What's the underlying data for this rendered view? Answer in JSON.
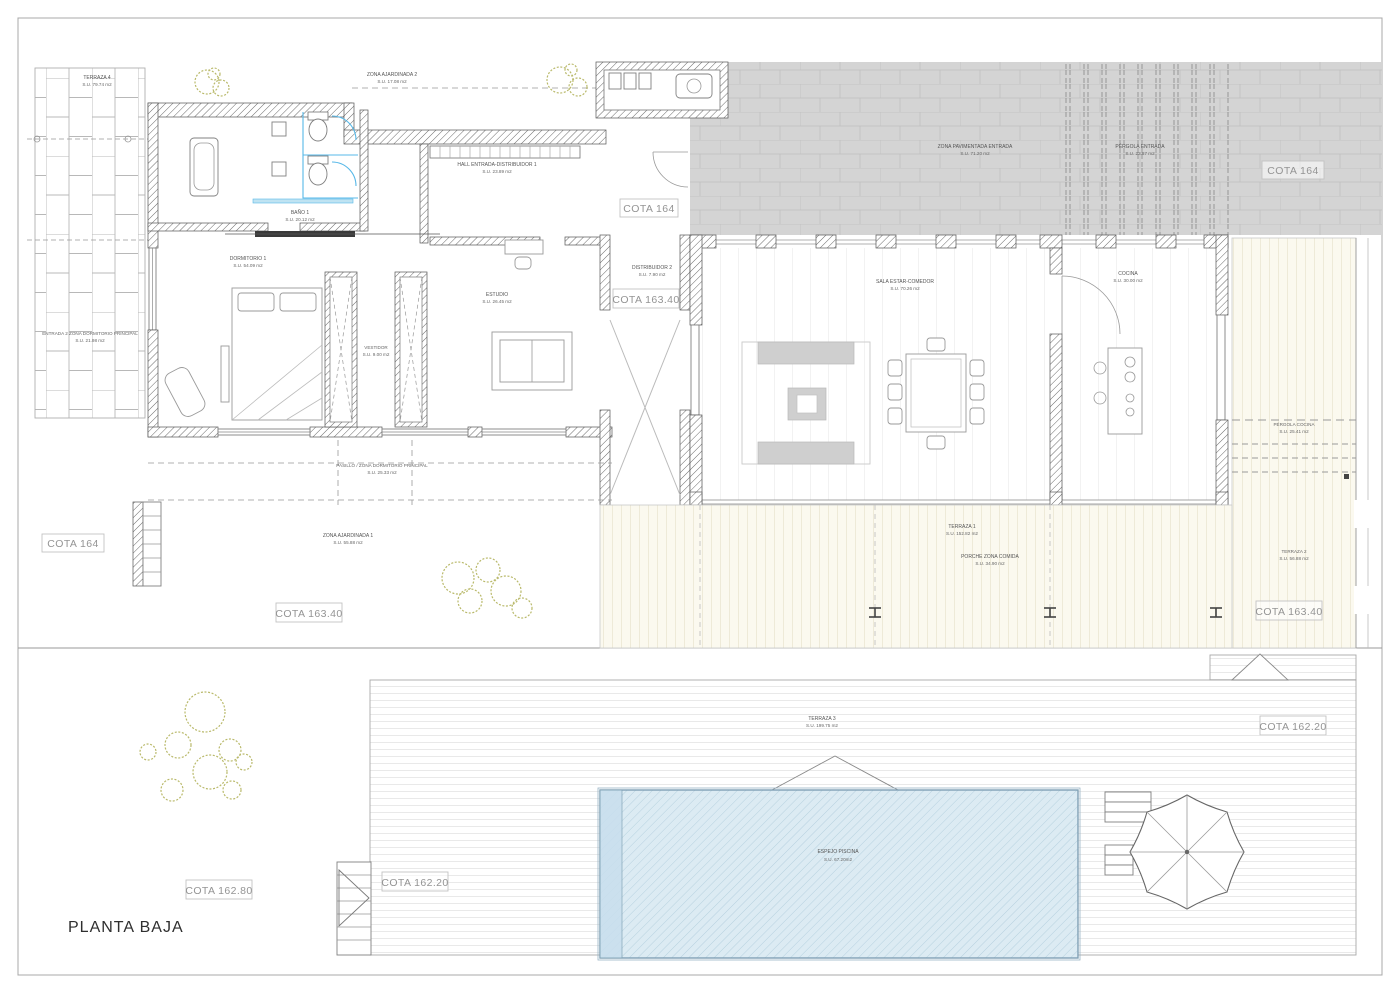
{
  "drawing": {
    "title": "PLANTA BAJA",
    "rooms": {
      "terraza4": {
        "name": "TERRAZA 4",
        "area": "S.U. 79.74 m2"
      },
      "entrada2": {
        "name": "ENTRADA 2 ZONA DORMITORIO PRINCIPAL",
        "area": "S.U. 21.98 m2"
      },
      "zonaAjardinada2": {
        "name": "ZONA AJARDINADA 2",
        "area": "S.U. 17.08 m2"
      },
      "bano1": {
        "name": "BAÑO 1",
        "area": "S.U. 20.12 m2"
      },
      "hall": {
        "name": "HALL ENTRADA-DISTRIBUIDOR 1",
        "area": "S.U. 23.89 m2"
      },
      "dormitorio1": {
        "name": "DORMITORIO 1",
        "area": "S.U. 54.09 m2"
      },
      "vestidor": {
        "name": "VESTIDOR",
        "area": "S.U. 9.00 m2"
      },
      "estudio": {
        "name": "ESTUDIO",
        "area": "S.U. 26.45 m2"
      },
      "distribuidor2": {
        "name": "DISTRIBUIDOR 2",
        "area": "S.U. 7.90 m2"
      },
      "salaEstar": {
        "name": "SALA ESTAR-COMEDOR",
        "area": "S.U. 70.26 m2"
      },
      "cocina": {
        "name": "COCINA",
        "area": "S.U. 30.00 m2"
      },
      "zonaPavimentada": {
        "name": "ZONA PAVIMENTADA ENTRADA",
        "area": "S.U. 71.20 m2"
      },
      "pergolaEntrada": {
        "name": "PÉRGOLA ENTRADA",
        "area": "S.U. 23.87 m2"
      },
      "pergolaCocina": {
        "name": "PÉRGOLA COCINA",
        "area": "S.U. 25.41 m2"
      },
      "terraza2": {
        "name": "TERRAZA 2",
        "area": "S.U. 56.88 m2"
      },
      "terraza1": {
        "name": "TERRAZA 1",
        "area": "S.U. 152.82 m2"
      },
      "porcheComida": {
        "name": "PORCHE ZONA COMIDA",
        "area": "S.U. 34.90 m2"
      },
      "pasillo": {
        "name": "PASILLO / ZONA DORMITORIO PRINCIPAL",
        "area": "S.U. 25.33 m2"
      },
      "zonaAjardinada1": {
        "name": "ZONA AJARDINADA 1",
        "area": "S.U. 55.88 m2"
      },
      "terraza3": {
        "name": "TERRAZA 3",
        "area": "S.U. 199.75 m2"
      },
      "espejoPiscina": {
        "name": "ESPEJO PISCINA",
        "area": "S.U. 67.20m2"
      }
    },
    "cotas": {
      "cota_164": "COTA 164",
      "cota_163_40": "COTA 163.40",
      "cota_162_80": "COTA 162.80",
      "cota_162_20": "COTA 162.20"
    },
    "colors": {
      "paving_gray": "#d4d4d4",
      "deck_cream": "#fbf9ef",
      "deck_line": "#d9d2b4",
      "pool_blue": "#dcebf3",
      "pool_hatch": "#b2cedd",
      "plant_green": "#b9b96a",
      "fixture_blue": "#57b8e8",
      "wall_hatch": "#6a6a6a"
    }
  }
}
